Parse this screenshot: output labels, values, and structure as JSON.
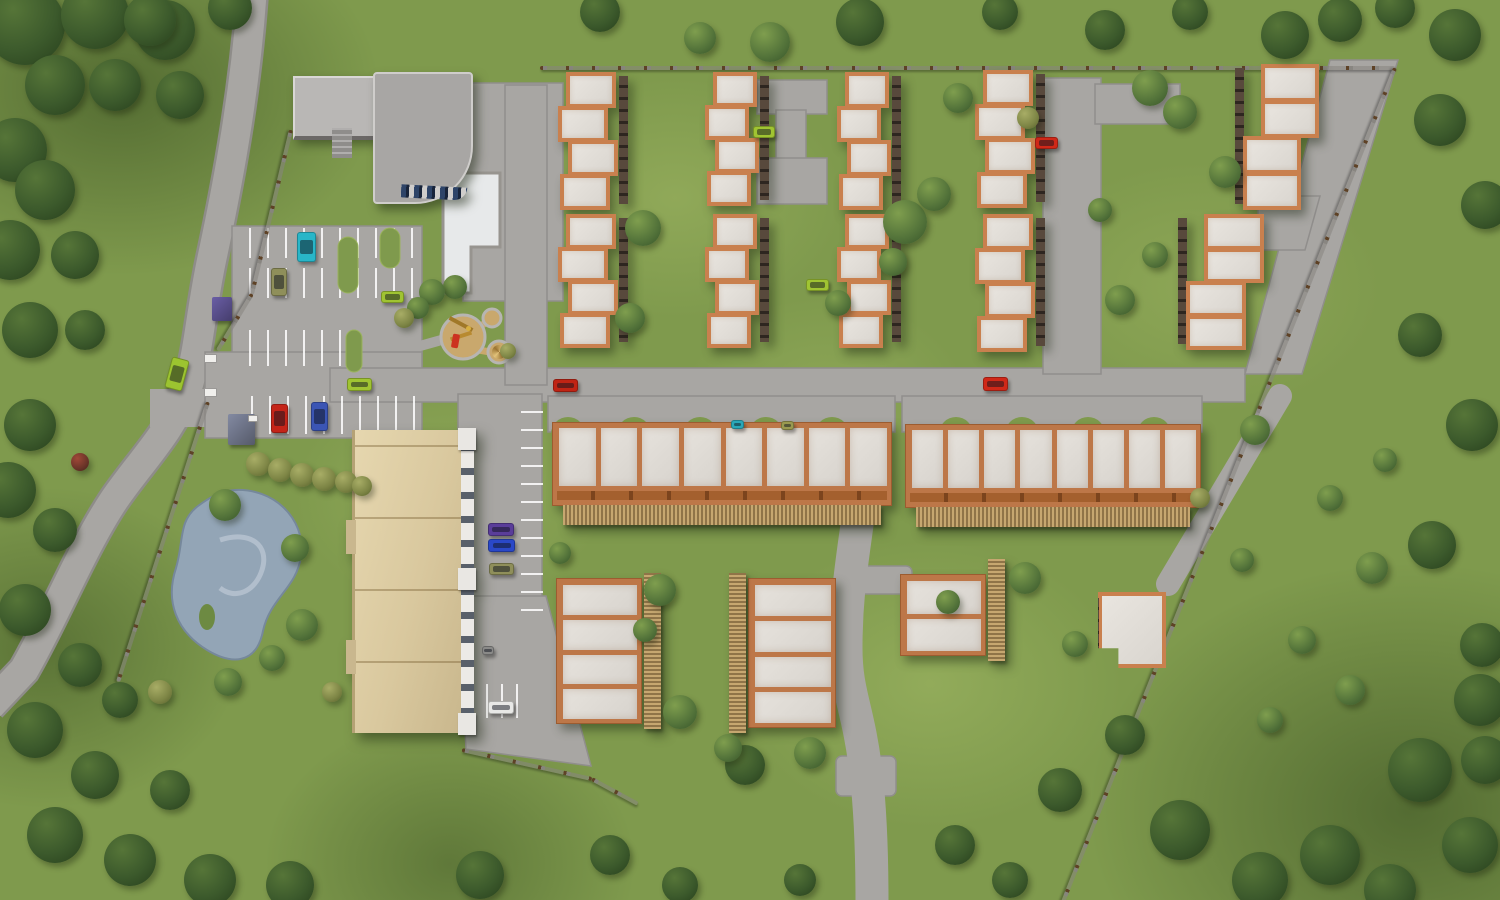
{
  "scene": {
    "description": "Aerial 3D site-plan render of a suburban residential complex with townhouse rows, long garage buildings, an apartment block, community building with pool, playground, pond, parking lots and boundary fences",
    "palette": {
      "grass": "#7f9a4d",
      "grass_light": "#a3b762",
      "grass_dark": "#55703a",
      "road": "#a8a6a3",
      "road_edge": "#8e8c89",
      "marking": "#ffffff",
      "roof_panel": "#e0dcd6",
      "roof_trim": "#c9804e",
      "trim_dark": "#a4602e",
      "facade_shadow": "#4f443c",
      "wood_fence": "#b39a6a",
      "beige_roof": "#dbc9a0",
      "gray_roof": "#a8a6a4",
      "gray_roof_light": "#b9b7b5",
      "pool": "#e7e9ea",
      "pond": "#93a5b6",
      "playground_sand": "#c9a86d",
      "fence_post": "#5e4226",
      "tree_dark": "#3c5a2c",
      "tree_mid": "#53733a",
      "tree_olive": "#7d8545"
    }
  },
  "townhouses": {
    "fields": [
      "x",
      "y",
      "w",
      "h",
      "units",
      "shade",
      "offsets"
    ],
    "items": [
      [
        558,
        70,
        62,
        140,
        4,
        "right",
        [
          8,
          0,
          10,
          2
        ]
      ],
      [
        558,
        212,
        62,
        136,
        4,
        "right",
        [
          8,
          0,
          10,
          2
        ]
      ],
      [
        705,
        70,
        56,
        136,
        4,
        "right",
        [
          8,
          0,
          10,
          2
        ]
      ],
      [
        705,
        212,
        56,
        136,
        4,
        "right",
        [
          8,
          0,
          10,
          2
        ]
      ],
      [
        837,
        70,
        56,
        140,
        4,
        "right",
        [
          8,
          0,
          10,
          2
        ]
      ],
      [
        837,
        212,
        56,
        136,
        4,
        "right",
        [
          8,
          0,
          10,
          2
        ]
      ],
      [
        975,
        68,
        62,
        140,
        4,
        "right",
        [
          8,
          0,
          10,
          2
        ]
      ],
      [
        975,
        212,
        62,
        140,
        4,
        "right",
        [
          8,
          0,
          10,
          2
        ]
      ],
      [
        1243,
        62,
        70,
        148,
        4,
        "left",
        [
          18,
          18,
          0,
          0
        ]
      ],
      [
        1186,
        212,
        72,
        138,
        4,
        "left",
        [
          18,
          18,
          0,
          0
        ]
      ]
    ]
  },
  "long_buildings": {
    "fields": [
      "x",
      "y",
      "w",
      "h",
      "panels"
    ],
    "items": [
      [
        552,
        422,
        340,
        84,
        8
      ],
      [
        905,
        424,
        296,
        84,
        8
      ]
    ]
  },
  "court_buildings": {
    "fields": [
      "x",
      "y",
      "w",
      "h",
      "panels",
      "fence_side"
    ],
    "items": [
      [
        556,
        578,
        86,
        146,
        4,
        "right"
      ],
      [
        748,
        578,
        88,
        150,
        4,
        "left"
      ],
      [
        900,
        574,
        86,
        82,
        2,
        "right"
      ]
    ]
  },
  "flat_building": {
    "x": 1098,
    "y": 592,
    "w": 68,
    "h": 76
  },
  "apartment_building": {
    "x": 352,
    "y": 430,
    "w": 106,
    "h": 303
  },
  "community_building": {
    "wing_a": [
      293,
      76,
      84,
      58
    ],
    "wing_b": [
      373,
      72,
      96,
      128
    ]
  },
  "cars": {
    "fields": [
      "x",
      "y",
      "w",
      "h",
      "color",
      "angle"
    ],
    "items": [
      [
        297,
        232,
        19,
        30,
        "#29b6c8",
        0
      ],
      [
        271,
        268,
        16,
        28,
        "#8f8f5a",
        0
      ],
      [
        271,
        404,
        17,
        29,
        "#c42418",
        0
      ],
      [
        311,
        402,
        17,
        29,
        "#3b55b4",
        0
      ],
      [
        347,
        378,
        25,
        13,
        "#a0c432",
        0
      ],
      [
        168,
        358,
        18,
        32,
        "#9cc430",
        15
      ],
      [
        381,
        291,
        23,
        12,
        "#a0c432",
        0
      ],
      [
        753,
        126,
        22,
        12,
        "#a0c432",
        0
      ],
      [
        1035,
        137,
        23,
        12,
        "#d02818",
        0
      ],
      [
        806,
        279,
        23,
        12,
        "#a0c432",
        0
      ],
      [
        553,
        379,
        25,
        13,
        "#c02414",
        0
      ],
      [
        983,
        377,
        25,
        14,
        "#d02818",
        0
      ],
      [
        731,
        420,
        13,
        9,
        "#2aa8b8",
        0
      ],
      [
        781,
        421,
        13,
        9,
        "#9a9a50",
        0
      ],
      [
        488,
        523,
        26,
        13,
        "#5a3d9a",
        0
      ],
      [
        488,
        539,
        27,
        13,
        "#2a48c8",
        0
      ],
      [
        489,
        563,
        25,
        12,
        "#8f8f5a",
        0
      ],
      [
        482,
        646,
        12,
        9,
        "#8a8a88",
        0
      ],
      [
        488,
        701,
        26,
        13,
        "#e8e8e6",
        0
      ]
    ]
  },
  "fences": {
    "fields": [
      "x1",
      "y1",
      "x2",
      "y2"
    ],
    "items": [
      [
        540,
        66,
        1395,
        66
      ],
      [
        1395,
        66,
        1063,
        900
      ],
      [
        291,
        128,
        252,
        292
      ],
      [
        252,
        292,
        218,
        348
      ],
      [
        208,
        400,
        118,
        680
      ],
      [
        462,
        748,
        592,
        777
      ],
      [
        592,
        777,
        638,
        802
      ]
    ]
  },
  "shelters": {
    "fields": [
      "x",
      "y",
      "w",
      "h",
      "color"
    ],
    "items": [
      [
        212,
        297,
        20,
        24,
        "#6a5ea6"
      ],
      [
        228,
        414,
        27,
        31,
        "#838aa2"
      ]
    ]
  },
  "gate_posts": {
    "fields": [
      "x",
      "y",
      "w",
      "h"
    ],
    "items": [
      [
        204,
        354,
        13,
        9
      ],
      [
        204,
        388,
        13,
        9
      ],
      [
        248,
        415,
        10,
        7
      ]
    ]
  },
  "trees": {
    "fields": [
      "cx",
      "cy",
      "r",
      "tone"
    ],
    "items": [
      [
        25,
        25,
        40,
        "d"
      ],
      [
        95,
        15,
        34,
        "d"
      ],
      [
        165,
        30,
        30,
        "d"
      ],
      [
        55,
        85,
        30,
        "d"
      ],
      [
        15,
        150,
        32,
        "d"
      ],
      [
        115,
        85,
        26,
        "d"
      ],
      [
        180,
        95,
        24,
        "d"
      ],
      [
        45,
        190,
        30,
        "d"
      ],
      [
        10,
        250,
        30,
        "d"
      ],
      [
        75,
        255,
        24,
        "d"
      ],
      [
        30,
        330,
        28,
        "d"
      ],
      [
        85,
        330,
        20,
        "d"
      ],
      [
        150,
        20,
        26,
        "d"
      ],
      [
        230,
        8,
        22,
        "d"
      ],
      [
        30,
        425,
        26,
        "d"
      ],
      [
        8,
        490,
        28,
        "d"
      ],
      [
        55,
        530,
        22,
        "d"
      ],
      [
        25,
        610,
        26,
        "d"
      ],
      [
        80,
        665,
        22,
        "d"
      ],
      [
        35,
        730,
        28,
        "d"
      ],
      [
        95,
        775,
        24,
        "d"
      ],
      [
        55,
        835,
        28,
        "d"
      ],
      [
        130,
        860,
        26,
        "d"
      ],
      [
        210,
        880,
        26,
        "d"
      ],
      [
        290,
        885,
        24,
        "d"
      ],
      [
        170,
        790,
        20,
        "d"
      ],
      [
        120,
        700,
        18,
        "d"
      ],
      [
        480,
        875,
        24,
        "d"
      ],
      [
        610,
        855,
        20,
        "d"
      ],
      [
        680,
        885,
        18,
        "d"
      ],
      [
        745,
        765,
        20,
        "d"
      ],
      [
        800,
        880,
        16,
        "d"
      ],
      [
        955,
        845,
        20,
        "d"
      ],
      [
        1060,
        790,
        22,
        "d"
      ],
      [
        1125,
        735,
        20,
        "d"
      ],
      [
        1010,
        880,
        18,
        "d"
      ],
      [
        1180,
        830,
        30,
        "d"
      ],
      [
        1260,
        880,
        28,
        "d"
      ],
      [
        1330,
        855,
        30,
        "d"
      ],
      [
        1420,
        770,
        32,
        "d"
      ],
      [
        1470,
        845,
        28,
        "d"
      ],
      [
        1390,
        890,
        26,
        "d"
      ],
      [
        1480,
        700,
        26,
        "d"
      ],
      [
        1485,
        760,
        24,
        "d"
      ],
      [
        1440,
        120,
        26,
        "d"
      ],
      [
        1485,
        205,
        24,
        "d"
      ],
      [
        1420,
        335,
        22,
        "d"
      ],
      [
        1472,
        425,
        26,
        "d"
      ],
      [
        1432,
        545,
        24,
        "d"
      ],
      [
        1482,
        645,
        22,
        "d"
      ],
      [
        1340,
        20,
        22,
        "d"
      ],
      [
        1395,
        8,
        20,
        "d"
      ],
      [
        1455,
        35,
        26,
        "d"
      ],
      [
        600,
        12,
        20,
        "d"
      ],
      [
        860,
        22,
        24,
        "d"
      ],
      [
        1000,
        12,
        18,
        "d"
      ],
      [
        1105,
        30,
        20,
        "d"
      ],
      [
        1190,
        12,
        18,
        "d"
      ],
      [
        1285,
        35,
        24,
        "d"
      ],
      [
        643,
        228,
        18,
        "m"
      ],
      [
        630,
        318,
        15,
        "m"
      ],
      [
        770,
        42,
        20,
        "m"
      ],
      [
        700,
        38,
        16,
        "m"
      ],
      [
        905,
        222,
        22,
        "m"
      ],
      [
        934,
        194,
        17,
        "m"
      ],
      [
        893,
        262,
        14,
        "m"
      ],
      [
        838,
        303,
        13,
        "m"
      ],
      [
        958,
        98,
        15,
        "m"
      ],
      [
        1150,
        88,
        18,
        "m"
      ],
      [
        1180,
        112,
        17,
        "m"
      ],
      [
        1225,
        172,
        16,
        "m"
      ],
      [
        1120,
        300,
        15,
        "m"
      ],
      [
        1155,
        255,
        13,
        "m"
      ],
      [
        1100,
        210,
        12,
        "m"
      ],
      [
        225,
        505,
        16,
        "m"
      ],
      [
        295,
        548,
        14,
        "m"
      ],
      [
        302,
        625,
        16,
        "m"
      ],
      [
        272,
        658,
        13,
        "m"
      ],
      [
        228,
        682,
        14,
        "m"
      ],
      [
        455,
        287,
        12,
        "m"
      ],
      [
        432,
        292,
        13,
        "m"
      ],
      [
        418,
        308,
        11,
        "m"
      ],
      [
        560,
        553,
        11,
        "m"
      ],
      [
        660,
        590,
        16,
        "m"
      ],
      [
        680,
        712,
        17,
        "m"
      ],
      [
        810,
        753,
        16,
        "m"
      ],
      [
        728,
        748,
        14,
        "m"
      ],
      [
        1025,
        578,
        16,
        "m"
      ],
      [
        1075,
        644,
        13,
        "m"
      ],
      [
        948,
        602,
        12,
        "m"
      ],
      [
        645,
        630,
        12,
        "m"
      ],
      [
        1255,
        430,
        15,
        "m"
      ],
      [
        1330,
        498,
        13,
        "m"
      ],
      [
        1372,
        568,
        16,
        "m"
      ],
      [
        1302,
        640,
        14,
        "m"
      ],
      [
        1242,
        560,
        12,
        "m"
      ],
      [
        1385,
        460,
        12,
        "m"
      ],
      [
        1350,
        690,
        15,
        "m"
      ],
      [
        1270,
        720,
        13,
        "m"
      ],
      [
        258,
        464,
        12,
        "o"
      ],
      [
        280,
        470,
        12,
        "o"
      ],
      [
        302,
        475,
        12,
        "o"
      ],
      [
        324,
        479,
        12,
        "o"
      ],
      [
        346,
        482,
        11,
        "o"
      ],
      [
        362,
        486,
        10,
        "o"
      ],
      [
        404,
        318,
        10,
        "o"
      ],
      [
        508,
        351,
        8,
        "o"
      ],
      [
        160,
        692,
        12,
        "o"
      ],
      [
        332,
        692,
        10,
        "o"
      ],
      [
        1200,
        498,
        10,
        "o"
      ],
      [
        1028,
        118,
        11,
        "o"
      ],
      [
        80,
        462,
        9,
        "r"
      ]
    ]
  }
}
